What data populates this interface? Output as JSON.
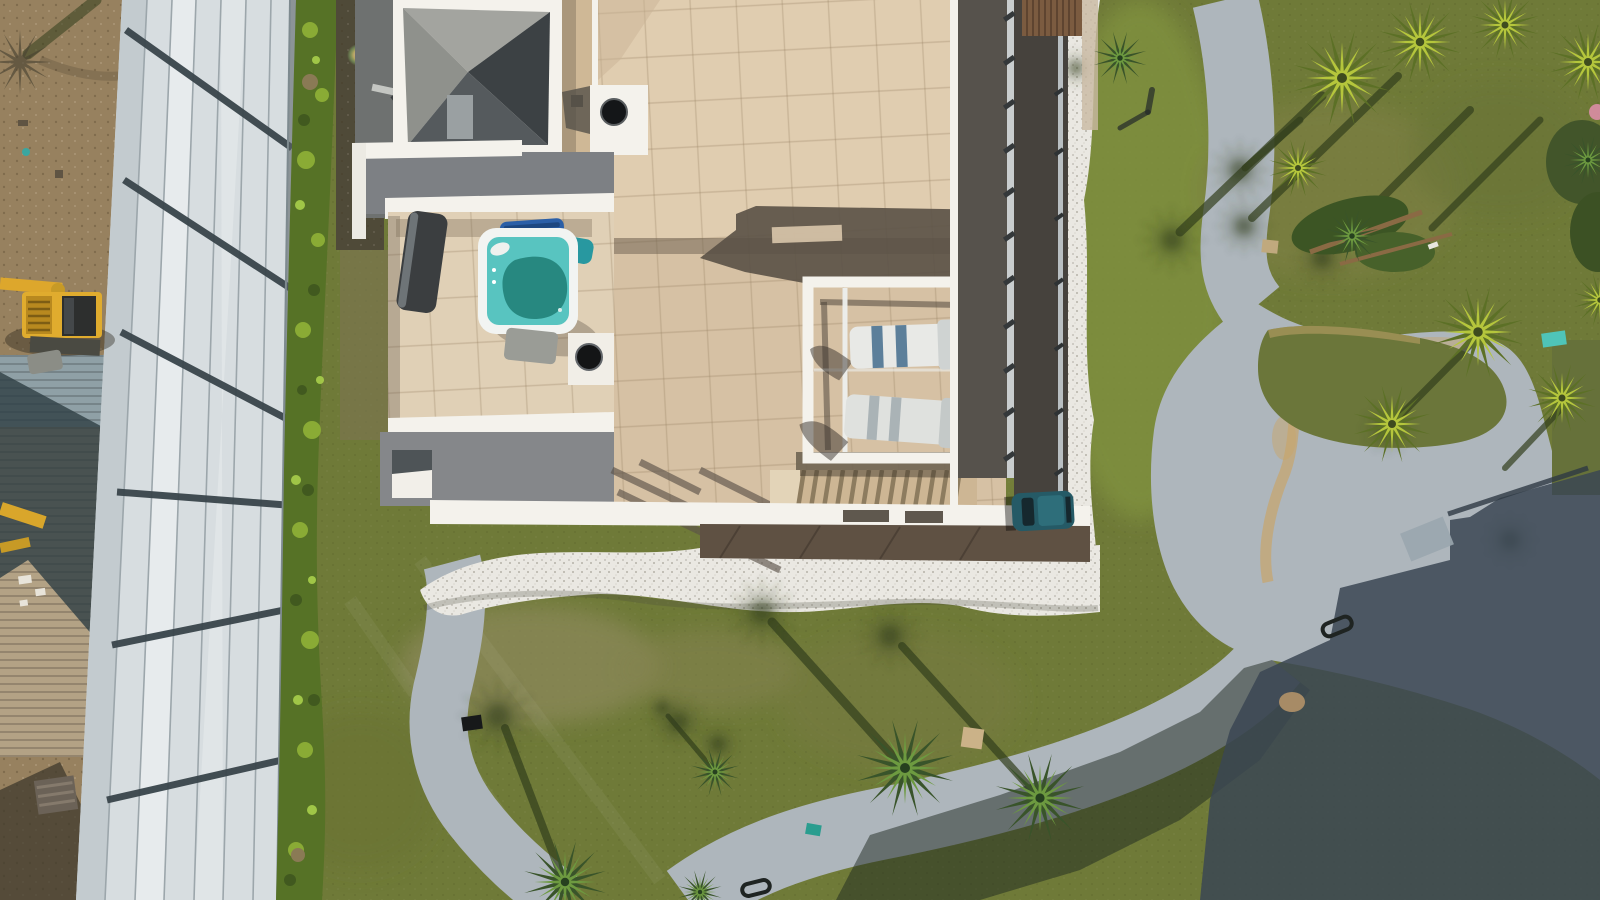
{
  "meta": {
    "description": "Aerial top-down drone photograph of a modern white villa with a beige rooftop terrace, hot tub, pergola with sun loungers, staircase, parked car, white gravel borders, winding concrete paths, lawns with palm trees, a large panel warehouse roof on the left with a yellow excavator, and long afternoon shadows."
  },
  "scene": {
    "objects": [
      {
        "id": "warehouse-roof",
        "label": "large light metal panel roof with dark rails"
      },
      {
        "id": "hedge",
        "label": "green hedge row"
      },
      {
        "id": "excavator",
        "label": "yellow excavator on dirt"
      },
      {
        "id": "villa",
        "label": "white villa with beige tiled roof terraces"
      },
      {
        "id": "hot-tub",
        "label": "square hot tub with turquoise water"
      },
      {
        "id": "pergola",
        "label": "white pergola frame with two sun loungers"
      },
      {
        "id": "staircase",
        "label": "exterior staircase"
      },
      {
        "id": "parked-car",
        "label": "dark teal car"
      },
      {
        "id": "gravel-border",
        "label": "white decorative gravel band"
      },
      {
        "id": "paths",
        "label": "gray winding concrete footpaths and driveway"
      },
      {
        "id": "palm-trees",
        "label": "palm trees casting long shadows"
      },
      {
        "id": "lawn",
        "label": "olive green lawn with dry patches"
      }
    ]
  },
  "colors": {
    "grass": "#6f7a38",
    "grassBright": "#7f913f",
    "grassDark": "#5c6830",
    "shadowGreen": "#323e1c",
    "dirt": "#97815f",
    "roofPanel": "#d7dde0",
    "roofRail": "#39454b",
    "hedge": "#567226",
    "hedgeBright": "#8aab35",
    "concrete": "#aeb6bc",
    "concreteShade": "#56646e",
    "terrace": "#e0cdb0",
    "terraceMid": "#d6c1a4",
    "white": "#f4f2ec",
    "pyramidLit": "#a3a49f",
    "pyramidDark": "#3c4144",
    "deckDark": "#56524c",
    "balcony": "#46423d",
    "gravel": "#eae8e2",
    "water": "#58c4c0",
    "waterDeep": "#1f7e74",
    "cover": "#3b3e40",
    "towelBlue": "#2b5fa7",
    "towelTeal": "#2898a0",
    "car": "#255a66",
    "excavator": "#dda72c",
    "sand": "#c8a56b",
    "wood": "#5f5143",
    "corrugTan": "#b3a285",
    "corrugBlue": "#8fa0a6",
    "shadowDark": "#3b4754"
  }
}
